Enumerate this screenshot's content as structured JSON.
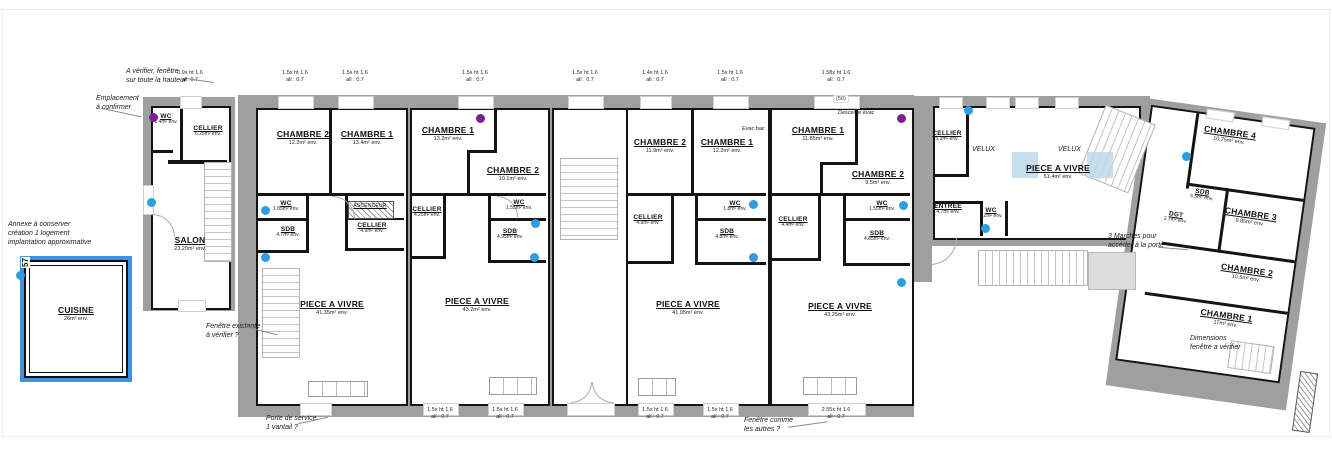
{
  "colors": {
    "wall_gray": "#9f9f9f",
    "wall_black": "#141414",
    "highlight_blue": "#3f93dd",
    "marker_blue": "#2f9be0",
    "marker_purple": "#7a2090",
    "velux_blue": "#bdd8ec"
  },
  "rooms": [
    {
      "name": "WC",
      "area": "1.4m² env."
    },
    {
      "name": "CELLIER",
      "area": "6.25m² env."
    },
    {
      "name": "SALON",
      "area": "23.20m² env."
    },
    {
      "name": "CHAMBRE 2",
      "area": "12.2m² env."
    },
    {
      "name": "CHAMBRE 1",
      "area": "13.4m² env."
    },
    {
      "name": "WC",
      "area": "1.85m² env."
    },
    {
      "name": "SDB",
      "area": "4.7m² env."
    },
    {
      "name": "ASCENCEUR",
      "area": ""
    },
    {
      "name": "CELLIER",
      "area": "4.9m² env."
    },
    {
      "name": "PIECE A VIVRE",
      "area": "41.35m² env."
    },
    {
      "name": "CHAMBRE 1",
      "area": "13.2m² env."
    },
    {
      "name": "CHAMBRE 2",
      "area": "10.1m² env."
    },
    {
      "name": "WC",
      "area": "1.55m² env."
    },
    {
      "name": "CELLIER",
      "area": "4.25m² env."
    },
    {
      "name": "SDB",
      "area": "4.95m² env."
    },
    {
      "name": "PIECE A VIVRE",
      "area": "43.2m² env."
    },
    {
      "name": "CHAMBRE 2",
      "area": "11.9m² env."
    },
    {
      "name": "CHAMBRE 1",
      "area": "12.2m² env."
    },
    {
      "name": "WC",
      "area": "1.8m² env."
    },
    {
      "name": "CELLIER",
      "area": "4.9m² env."
    },
    {
      "name": "SDB",
      "area": "4.8m² env."
    },
    {
      "name": "PIECE A VIVRE",
      "area": "41.95m² env."
    },
    {
      "name": "CHAMBRE 1",
      "area": "11.85m² env."
    },
    {
      "name": "CHAMBRE 2",
      "area": "9.5m² env."
    },
    {
      "name": "WC",
      "area": "1.55m² env."
    },
    {
      "name": "CELLIER",
      "area": "4.4m² env."
    },
    {
      "name": "SDB",
      "area": "4.85m² env."
    },
    {
      "name": "PIECE A VIVRE",
      "area": "43.25m² env."
    },
    {
      "name": "CELLIER",
      "area": "5.3m² env."
    },
    {
      "name": "ENTREE",
      "area": "4.7m² env."
    },
    {
      "name": "WC",
      "area": "1.2m² env."
    },
    {
      "name": "PIECE A VIVRE",
      "area": "51.4m² env."
    },
    {
      "name": "CHAMBRE 4",
      "area": "10.75m² env."
    },
    {
      "name": "SDB",
      "area": "5.5m² env."
    },
    {
      "name": "DGT",
      "area": "2.7m² env."
    },
    {
      "name": "CHAMBRE 3",
      "area": "9.85m² env."
    },
    {
      "name": "CHAMBRE 2",
      "area": "10.5m² env."
    },
    {
      "name": "CHAMBRE 1",
      "area": "17m² env."
    },
    {
      "name": "CUISINE",
      "area": "26m² env."
    }
  ],
  "annotations": {
    "verify_window": "A vérifier, fenêtre\nsur toute la hauteur",
    "emplacement": "Emplacement\nà confirmer",
    "annex_note": "Annexe à conserver\ncréation 1 logement\nimplantation approximative",
    "existing_window": "Fenêtre existante\nà vérifier ?",
    "service_door": "Porte de service\n1 vantail ?",
    "same_window": "Fenêtre comme\nles autres ?",
    "steps_note": "3 Marches pour\naccéder à la porte",
    "dimensions_note": "Dimensions\nfenêtre a vérifier",
    "descente": "Descente évac",
    "evac": "Evac bac"
  },
  "window_labels": [
    "0.9x ht 1.6\nall. 0.7",
    "1.5x ht 1.6\nall : 0.7",
    "1.5x ht 1.6\nall : 0.7",
    "1.5x ht 1.6\nall : 0.7",
    "1.5x ht 1.6\nall : 0.7",
    "1.4x ht 1.6\nall : 0.7",
    "1.5x ht 1.6\nall : 0.7",
    "1.58x ht 1.6\nall : 0.7",
    "1.5x ht 1.6\nall : 0.7",
    "1.5x ht 1.6\nall : 0.7",
    "1.5x ht 1.6\nall : 0.7",
    "1.5x ht 1.6\nall : 0.7",
    "2.55x ht 1.6\nall : 0.7"
  ],
  "misc": {
    "velux": "VELUX",
    "dim_50": "(50)",
    "dim_57": "57"
  }
}
